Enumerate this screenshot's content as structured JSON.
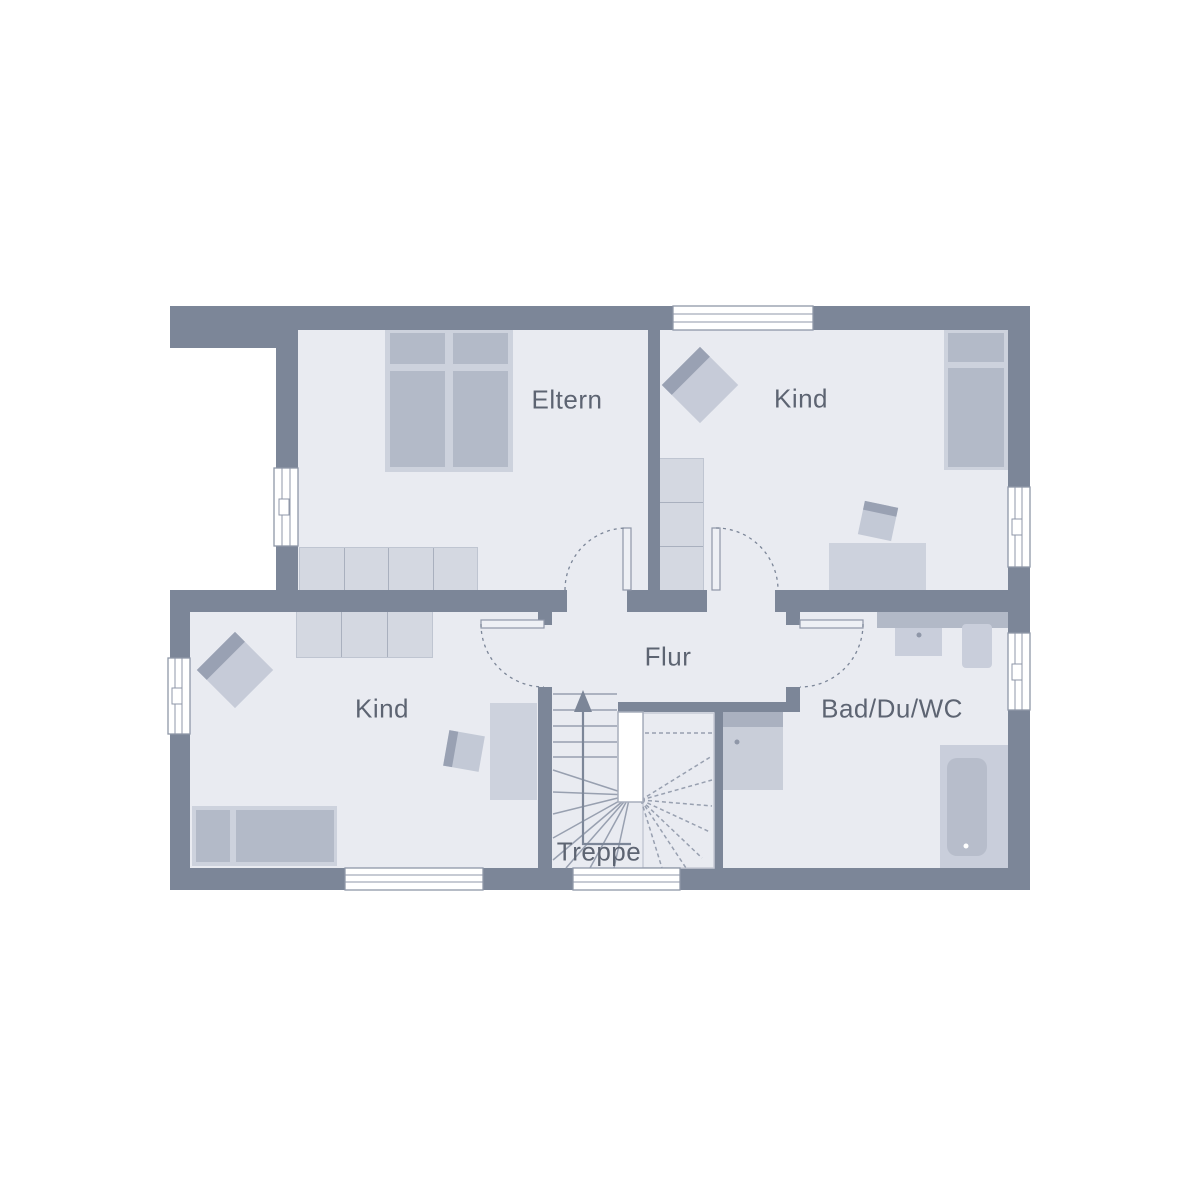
{
  "floorplan": {
    "rooms": [
      {
        "id": "eltern",
        "label": "Eltern"
      },
      {
        "id": "kind-top",
        "label": "Kind"
      },
      {
        "id": "kind-bottom",
        "label": "Kind"
      },
      {
        "id": "flur",
        "label": "Flur"
      },
      {
        "id": "bad",
        "label": "Bad/Du/WC"
      },
      {
        "id": "treppe",
        "label": "Treppe"
      }
    ],
    "colors": {
      "background": "#ffffff",
      "floor": "#e9ebf1",
      "wall": "#7c8698",
      "furniture_light": "#d4d8e1",
      "furniture_mid": "#c9cedb",
      "furniture_dark": "#b3bac8",
      "furniture_accent": "#99a1b3",
      "label_text": "#5d6472",
      "line": "#8f97a8"
    },
    "furniture": [
      "double-bed",
      "sideboard",
      "wardrobe",
      "armchair",
      "single-bed",
      "desk",
      "desk-chair",
      "washbasin",
      "wc",
      "shower",
      "bathtub",
      "winder-staircase"
    ]
  }
}
